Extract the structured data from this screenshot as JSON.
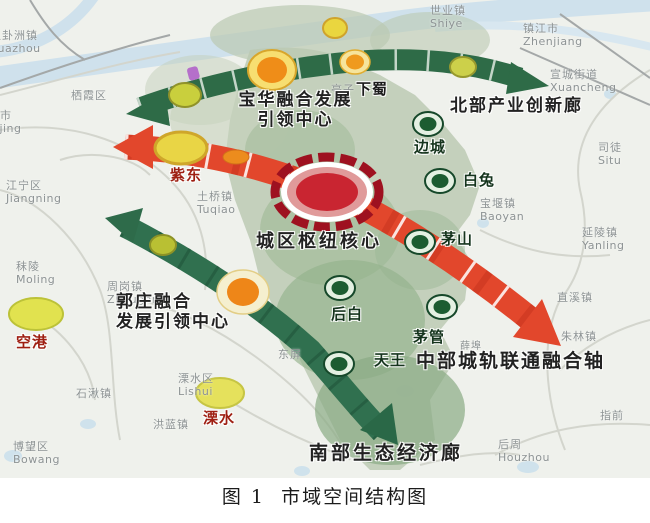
{
  "figure_caption": "图 1  市域空间结构图",
  "corridors": {
    "north_label": "北部产业创新廊",
    "central_axis_label": "中部城轨联通融合轴",
    "south_label": "南部生态经济廊",
    "baohua_line1": "宝华融合发展",
    "baohua_line2": "引领中心",
    "guozhuang_line1": "郭庄融合",
    "guozhuang_line2": "发展引领中心",
    "hub_label": "城区枢纽核心"
  },
  "towns": {
    "xiashu": "下蜀",
    "biancheng": "边城",
    "baitu": "白兔",
    "maoshan": "茅山",
    "houbai": "后白",
    "maoguan": "茅管",
    "tianwang": "天王",
    "zidong": "紫东",
    "konggang": "空港",
    "lishui": "溧水"
  },
  "basemap": {
    "guazhou": {
      "zh": "八卦洲镇",
      "en": "guazhou"
    },
    "qixia": {
      "zh": "栖霞区"
    },
    "nanjing": {
      "zh": "南京市",
      "en": "Nanjing"
    },
    "jiangning": {
      "zh": "江宁区",
      "en": "Jiangning"
    },
    "moling": {
      "zh": "秣陵",
      "en": "Moling"
    },
    "zhougang": {
      "zh": "周岗镇",
      "en": "Zhougang"
    },
    "shiqiu": {
      "zh": "石湫镇"
    },
    "lishui_district": {
      "zh": "溧水区",
      "en": "Lishui"
    },
    "honglan": {
      "zh": "洪蓝镇"
    },
    "bowang": {
      "zh": "博望区",
      "en": "Bowang"
    },
    "tuqiao": {
      "zh": "土桥镇",
      "en": "Tuqiao"
    },
    "tingzi": {
      "zh": "亭子"
    },
    "dongping": {
      "zh": "东屏"
    },
    "shiye": {
      "zh": "世业镇",
      "en": "Shiye"
    },
    "zhenjiang": {
      "zh": "镇江市",
      "en": "Zhenjiang"
    },
    "xuancheng": {
      "zh": "宣城街道",
      "en": "Xuancheng"
    },
    "situ": {
      "zh": "司徒",
      "en": "Situ"
    },
    "baoyan": {
      "zh": "宝堰镇",
      "en": "Baoyan"
    },
    "yanling": {
      "zh": "延陵镇",
      "en": "Yanling"
    },
    "zhixi": {
      "zh": "直溪镇"
    },
    "zhulin": {
      "zh": "朱林镇"
    },
    "zhiqian": {
      "zh": "指前"
    },
    "houzhou": {
      "zh": "后周",
      "en": "Houzhou"
    },
    "xuebu": {
      "zh": "薛埠"
    }
  },
  "colors": {
    "corridor_green": "#2e6b47",
    "axis_red": "#e2472c",
    "hub_core_red": "#c92531",
    "node_green": "#1c5c31",
    "node_orange": "#ef8d18",
    "node_yellow": "#e9d545",
    "region_green": "#b9c9b1",
    "water_blue": "#cfe1ec"
  }
}
